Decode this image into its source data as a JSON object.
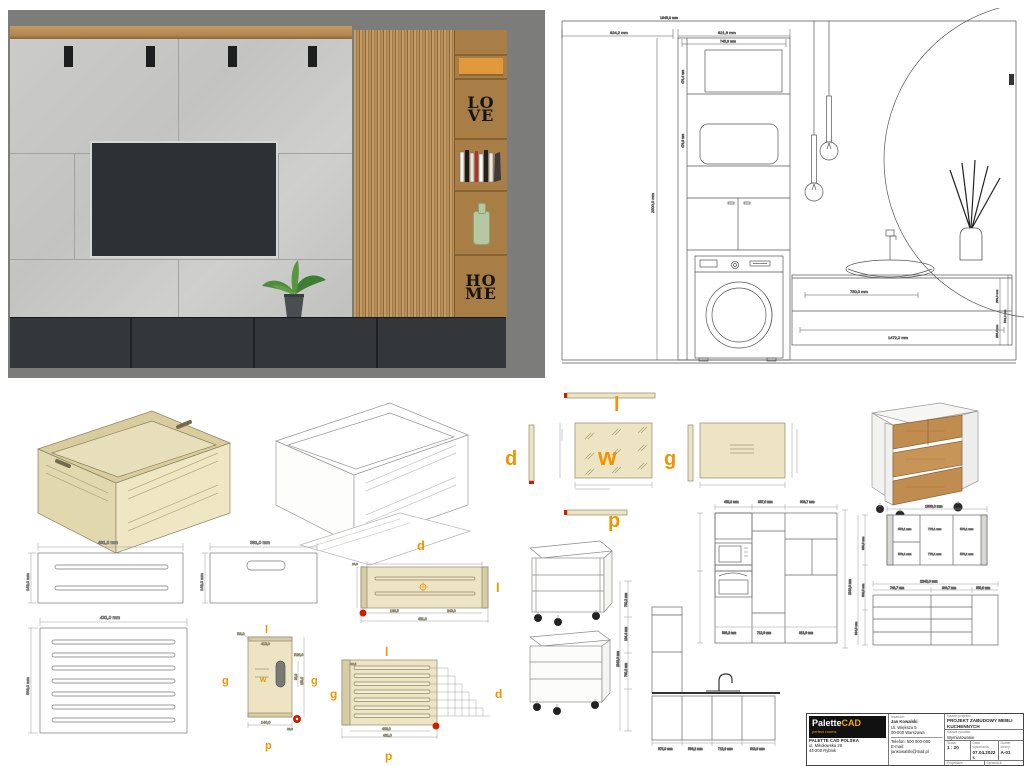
{
  "colors": {
    "accent_orange": "#f29400",
    "marker_red": "#cf1d00",
    "panel_beige": "#ece4c2",
    "wood": "#b98e55",
    "cabinet_dark": "#33373a"
  },
  "render": {
    "love1": "LO",
    "love2": "VE",
    "home1": "HO",
    "home2": "ME"
  },
  "bath": {
    "total_w": "1645,0 mm",
    "left_w": "824,2 mm",
    "cab_w": "821,9 mm",
    "cab_w_in": "745,9 mm",
    "room_h": "2500,0 mm",
    "shelf_h1": "476,4 mm",
    "shelf_h2": "476,8 mm",
    "drawer_w1": "750,0 mm",
    "vanity_w": "1472,2 mm",
    "v1": "233,0 mm",
    "v2": "255,0 mm",
    "v3": "543,0 mm"
  },
  "letters": {
    "l": "l",
    "d": "d",
    "w": "w",
    "g": "g",
    "p": "p"
  },
  "box": {
    "front_w": "481,0 mm",
    "front_h": "148,0 mm",
    "side_w": "381,0 mm",
    "side_h": "148,0 mm",
    "bottom_w": "431,0 mm",
    "bottom_h": "568,0 mm",
    "r1": "R3,0",
    "r2": "R25,0",
    "pw": "140,0",
    "pd1": "150,0",
    "pd2": "98,0",
    "pd3": "28,0",
    "plen": "413,0",
    "ld1": "138,5",
    "ld2": "240,0",
    "ld3": "481,0",
    "ld4": "16,0",
    "sd1": "403,0",
    "sd2": "431,0",
    "sr": "R2,5"
  },
  "kitchen": {
    "tt1": "452,3 mm",
    "tt2": "357,0 mm",
    "tt3": "603,7 mm",
    "tb1": "598,2 mm",
    "tb2": "712,9 mm",
    "tb3": "613,9 mm",
    "tall_h": "2342,0 mm",
    "run1": "572,0 mm",
    "run2": "596,2 mm",
    "run3": "712,9 mm",
    "run4": "613,9 mm",
    "chain1": "760,2 mm",
    "chain2": "194,4 mm",
    "chain3": "760,2 mm",
    "frame_w": "1869,0 mm",
    "fc1": "573,1 mm",
    "fc2": "773,1 mm",
    "fc3": "573,1 mm",
    "chest_w": "2242,0 mm",
    "cc1": "743,7 mm",
    "cc2": "844,7 mm",
    "cc3": "650,0 mm",
    "lc1": "650,0 mm",
    "lc2": "862,5 mm",
    "lc3": "504,5 mm"
  },
  "titleblock": {
    "brand1": "Palette",
    "brand2": "CAD",
    "tagline": "perfect rooms",
    "company": "PALETTE CAD POLSKA",
    "addr1": "ul. Mikołowska 29",
    "addr2": "44-200 Rybnik",
    "inv_label": "Inwestor:",
    "inv_name": "Jan Kowalski",
    "inv_addr1": "Ul. Większa 5",
    "inv_addr2": "00-000 Warszawa",
    "phone": "Telefon: 500 000-000",
    "email": "E-mail: jankowalski@mail.pl",
    "proj_label": "Nazwa projektu:",
    "proj": "PROJEKT ZABUDOWY MEBLI KUCHENNYCH",
    "draw_label": "Nazwa rysunku:",
    "draw": "Wymiarowanie",
    "scale_label": "Skala:",
    "scale": "1 : 20",
    "date_label": "Data wykonania:",
    "date": "07.04.2022 r.",
    "page_label": "Numer strony:",
    "page": "A-01",
    "designer_label": "Projektant:",
    "designer": "Stefan Projektant",
    "checker_label": "Sprawdził:",
    "checker": "Jarosław Projektant",
    "note": "Przed rozpoczęciem prac wszystkie wymiary SPRAWDZIĆ NA BUDOWIE, w przypadku niezgodności POWIADOMIĆ PROJEKTANTA"
  }
}
